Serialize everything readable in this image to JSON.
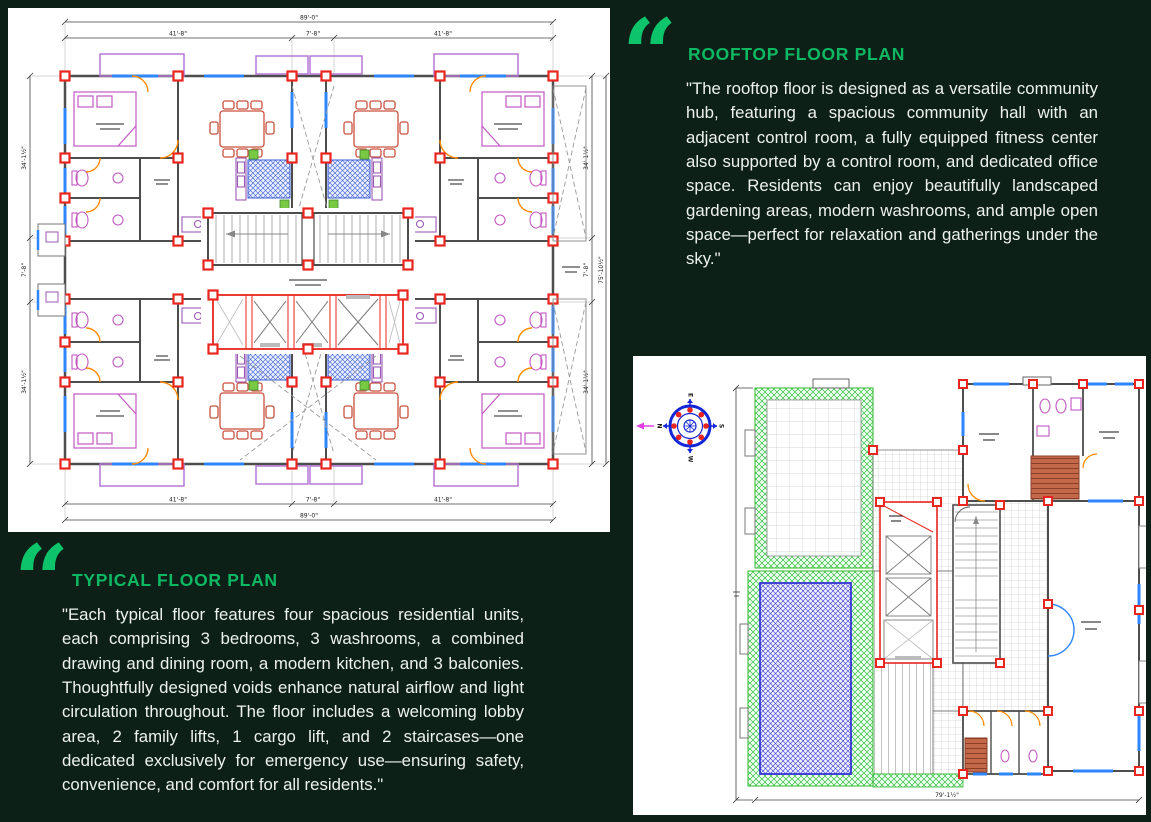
{
  "colors": {
    "background": "#0c2018",
    "accent_green": "#0db863",
    "quote_green": "#0ec46a",
    "panel_white": "#ffffff",
    "body_text": "#eef2ee",
    "column_red": "#e8251f",
    "wall_gray": "#4d4d4d",
    "window_blue": "#2e86ff",
    "door_orange": "#ff8a00",
    "furniture_magenta": "#c357c3",
    "dining_red": "#c9523f",
    "rug_blue": "#3b5bd6",
    "garden_green": "#2fbf3f",
    "pool_blue": "#3434d6",
    "stair_brown": "#a8543a",
    "balcony_purple": "#b678d8",
    "compass_blue": "#1326d8"
  },
  "quote_glyph": "“",
  "sections": {
    "rooftop": {
      "title": "ROOFTOP FLOOR PLAN",
      "body": "\"The rooftop floor is designed as a versatile community hub, featuring a spacious community hall with an adjacent control room, a fully equipped fitness center also supported by a control room, and dedicated office space. Residents can enjoy beautifully landscaped gardening areas, modern washrooms, and ample open space—perfect for relaxation and gatherings under the sky.\""
    },
    "typical": {
      "title": "TYPICAL FLOOR PLAN",
      "body": "\"Each typical floor features four spacious residential units, each comprising 3 bedrooms, 3 washrooms, a combined drawing and dining room, a modern kitchen, and 3 balconies. Thoughtfully designed voids enhance natural airflow and light circulation throughout. The floor includes a welcoming lobby area, 2 family lifts, 1 cargo lift, and 2 staircases—one dedicated exclusively for emergency use—ensuring safety, convenience, and comfort for all residents.\""
    }
  },
  "typical_plan": {
    "dims": {
      "top_total": "89'-0\"",
      "seg_long": "41'-8\"",
      "seg_short": "7'-8\"",
      "side_long": "34'-1½\"",
      "side_short": "7'-8\"",
      "side_total": "75'-10½\""
    }
  },
  "rooftop_plan": {
    "dims": {
      "bottom_total": "79'-1½\""
    },
    "compass": {
      "north": "N",
      "east": "E",
      "south": "S",
      "west": "W"
    }
  }
}
